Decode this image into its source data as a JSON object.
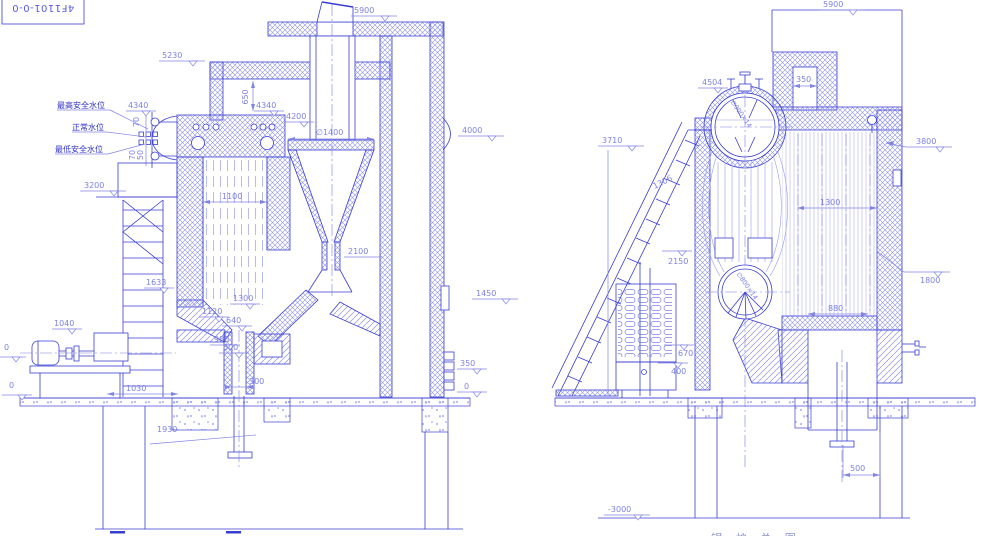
{
  "drawing": {
    "title_block_code": "4F1101-0-0",
    "bottom_caption": "锅 炉 总 图"
  },
  "colors": {
    "line": "#3a3ed0",
    "hatch": "#8d91ea",
    "dim_text": "#7d81e2",
    "label_text": "#2a2ec6"
  },
  "left_view": {
    "chimney_outlet_level": "5900",
    "roof_level": "5230",
    "water_level_high": "最高安全水位",
    "water_level_normal": "正常水位",
    "water_level_low": "最低安全水位",
    "level_4340_gauge": "4340",
    "gauge_70a": "70",
    "gauge_70b": "70",
    "gauge_50": "50",
    "platform_level_3200": "3200",
    "dim_650": "650",
    "level_4340": "4340",
    "level_4200": "4200",
    "cyclone_diameter": "∅1400",
    "level_4000": "4000",
    "furnace_width": "1100",
    "dim_1633": "1633",
    "dim_2100": "2100",
    "dim_1300": "1300",
    "dim_1120": "1120",
    "dim_640": "640",
    "dim_980": "980",
    "dim_600": "600",
    "dim_300": "300",
    "level_1040": "1040",
    "dim_1030": "1030",
    "level_0_a": "0",
    "level_0_b": "0",
    "level_1450": "1450",
    "level_350": "350",
    "level_0_rear": "0",
    "dim_1930": "1930"
  },
  "right_view": {
    "chimney_top_level": "5900",
    "flue_width": "350",
    "level_4504": "4504",
    "level_3710": "3710",
    "dim_1306": "1306",
    "level_2150": "2150",
    "upper_drum_spec": "∅900×14",
    "lower_drum_spec": "∅800×14",
    "bank_width": "1300",
    "level_3800": "3800",
    "level_1800": "1800",
    "dim_880": "880",
    "level_670": "670",
    "level_400": "400",
    "dim_500": "500",
    "level_minus_3000": "-3000"
  }
}
